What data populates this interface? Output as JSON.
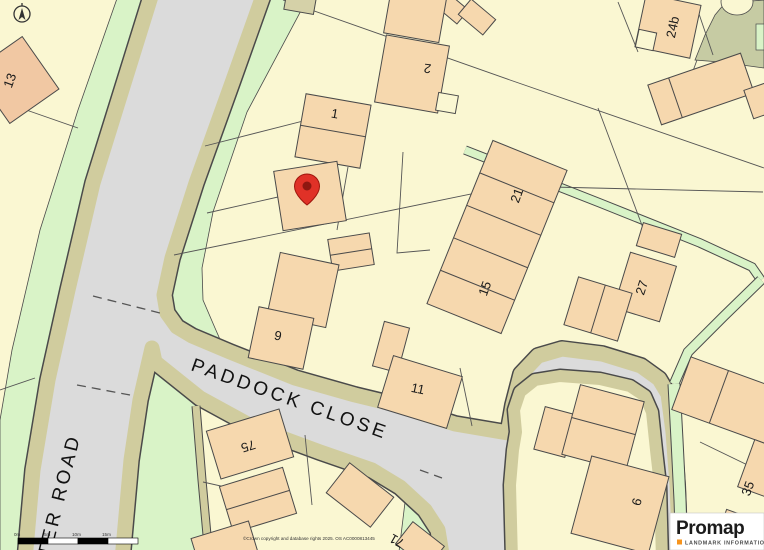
{
  "map": {
    "title": "Promap location map extract",
    "roads": {
      "close": "PADDOCK CLOSE",
      "road": "TER ROAD"
    },
    "plots": [
      {
        "label": "13"
      },
      {
        "label": "2"
      },
      {
        "label": "1"
      },
      {
        "label": "24b"
      },
      {
        "label": "21"
      },
      {
        "label": "15"
      },
      {
        "label": "27"
      },
      {
        "label": "9"
      },
      {
        "label": "11"
      },
      {
        "label": "75"
      },
      {
        "label": "71"
      },
      {
        "label": "6"
      },
      {
        "label": "35"
      }
    ],
    "scale_labels": [
      "0m",
      "5m",
      "10m",
      "15m"
    ],
    "copyright": "©Crown copyright and database rights 2025. OS AC0000813445",
    "colors": {
      "background": "#FAF7D2",
      "building": "#F6D8AE",
      "road": "#DBDBDB",
      "verge": "#D9F3C7",
      "kerb_path": "#D0CC9E",
      "scrub": "#C6CBA3",
      "pin": "#E03127"
    }
  },
  "logo": {
    "brand": "Promap",
    "tagline": "LANDMARK INFORMATION"
  }
}
